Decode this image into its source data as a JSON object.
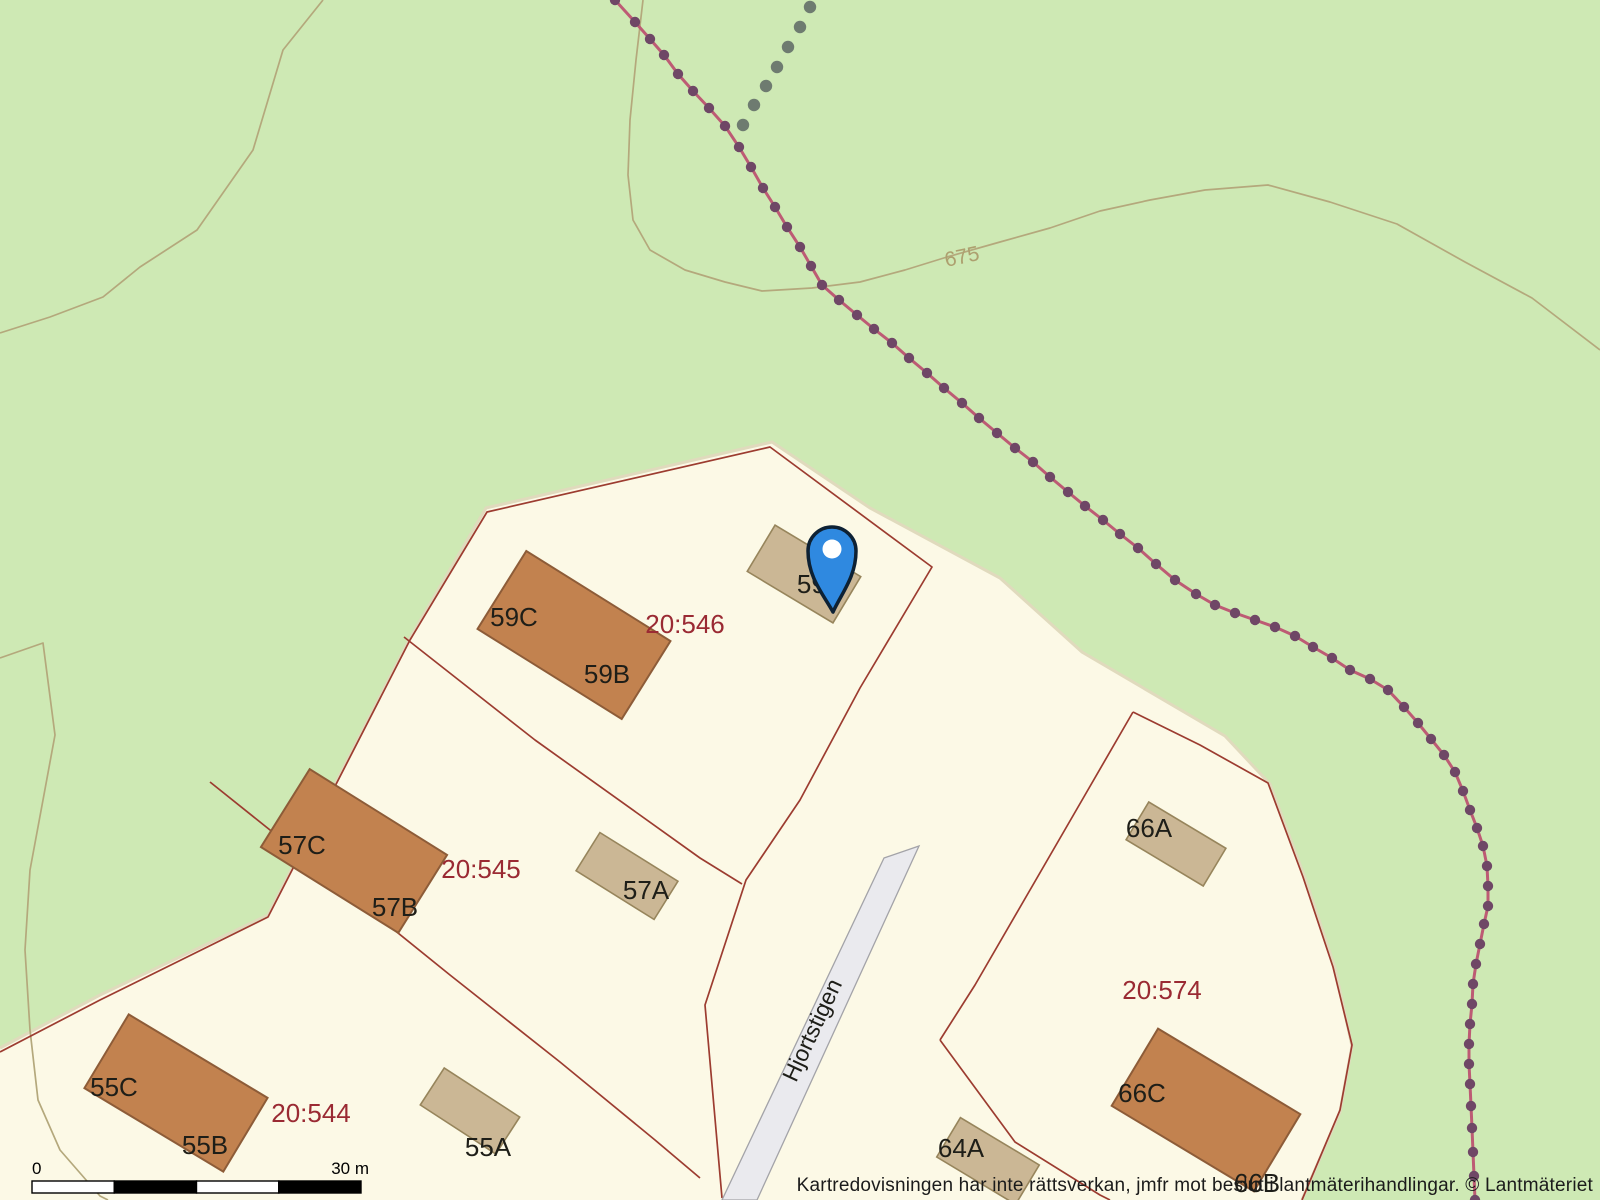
{
  "map": {
    "attribution": "Kartredovisningen har inte rättsverkan, jmfr mot beslut i lantmäterihandlingar. © Lantmäteriet",
    "scale_bar": {
      "start_label": "0",
      "end_label": "30 m",
      "x": 32,
      "y": 1181,
      "segment_width": 82.25,
      "height": 12,
      "segments": 4
    },
    "street": {
      "name": "Hjortstigen",
      "x": 812,
      "y": 1030,
      "rotation": -65
    },
    "contour_label": {
      "text": "675",
      "x": 962,
      "y": 257,
      "rotation": -12
    },
    "colors": {
      "bg_green": "#cee9b4",
      "cream": "#fcf9e6",
      "cream_edge": "#e0dabd",
      "contour": "#b4a87c",
      "contour_label": "#ada06f",
      "boundary": "#9c3c30",
      "parcel_label": "#9a2a33",
      "building_main": "#c2824f",
      "building_main_edge": "#8d5c38",
      "building_acc": "#cbb795",
      "building_acc_edge": "#97855c",
      "road_fill": "#eaeaee",
      "road_edge": "#a3a3a8",
      "trail_line": "#bd5b74",
      "trail_dot": "#6f4766",
      "gray_dot": "#6e7b70",
      "pin_fill": "#2f89e0",
      "pin_stroke": "#0d2134",
      "label_black": "#1e1e18"
    },
    "residential_area": [
      [
        0,
        1048
      ],
      [
        100,
        995
      ],
      [
        268,
        915
      ],
      [
        410,
        638
      ],
      [
        486,
        508
      ],
      [
        772,
        442
      ],
      [
        870,
        508
      ],
      [
        1000,
        578
      ],
      [
        1082,
        652
      ],
      [
        1225,
        736
      ],
      [
        1270,
        784
      ],
      [
        1305,
        878
      ],
      [
        1335,
        968
      ],
      [
        1352,
        1046
      ],
      [
        1340,
        1112
      ],
      [
        1302,
        1200
      ],
      [
        0,
        1200
      ]
    ],
    "residential_rim": [
      [
        0,
        1048
      ],
      [
        100,
        995
      ],
      [
        268,
        915
      ],
      [
        410,
        638
      ],
      [
        486,
        508
      ],
      [
        772,
        442
      ],
      [
        870,
        508
      ],
      [
        1000,
        578
      ],
      [
        1082,
        652
      ],
      [
        1225,
        736
      ],
      [
        1270,
        784
      ],
      [
        1305,
        878
      ],
      [
        1335,
        968
      ],
      [
        1352,
        1046
      ],
      [
        1340,
        1112
      ],
      [
        1302,
        1200
      ]
    ],
    "contours": [
      {
        "name": "contour-topleft",
        "points": [
          [
            323,
            0
          ],
          [
            283,
            50
          ],
          [
            253,
            150
          ],
          [
            197,
            230
          ],
          [
            140,
            267
          ],
          [
            103,
            297
          ],
          [
            50,
            317
          ],
          [
            0,
            333
          ]
        ]
      },
      {
        "name": "contour-675",
        "points": [
          [
            643,
            0
          ],
          [
            636,
            60
          ],
          [
            630,
            120
          ],
          [
            628,
            175
          ],
          [
            633,
            220
          ],
          [
            650,
            250
          ],
          [
            685,
            270
          ],
          [
            725,
            282
          ],
          [
            762,
            291
          ],
          [
            812,
            288
          ],
          [
            860,
            282
          ],
          [
            905,
            270
          ],
          [
            947,
            257
          ],
          [
            1000,
            242
          ],
          [
            1050,
            228
          ],
          [
            1100,
            211
          ],
          [
            1150,
            200
          ],
          [
            1205,
            190
          ],
          [
            1268,
            185
          ],
          [
            1330,
            202
          ],
          [
            1397,
            224
          ],
          [
            1465,
            262
          ],
          [
            1532,
            298
          ],
          [
            1600,
            350
          ]
        ]
      },
      {
        "name": "contour-left-hook",
        "points": [
          [
            0,
            658
          ],
          [
            43,
            643
          ],
          [
            55,
            735
          ],
          [
            43,
            800
          ],
          [
            30,
            870
          ],
          [
            25,
            950
          ],
          [
            30,
            1030
          ],
          [
            38,
            1100
          ],
          [
            60,
            1150
          ],
          [
            100,
            1196
          ],
          [
            108,
            1200
          ]
        ]
      }
    ],
    "boundaries": [
      {
        "name": "boundary-outer",
        "points": [
          [
            0,
            1052
          ],
          [
            100,
            1000
          ],
          [
            268,
            917
          ],
          [
            410,
            640
          ],
          [
            487,
            512
          ],
          [
            770,
            447
          ],
          [
            932,
            567
          ],
          [
            860,
            688
          ],
          [
            800,
            800
          ],
          [
            746,
            880
          ],
          [
            705,
            1005
          ],
          [
            722,
            1198
          ]
        ]
      },
      {
        "name": "boundary-546-545",
        "points": [
          [
            404,
            637
          ],
          [
            535,
            740
          ],
          [
            700,
            858
          ],
          [
            742,
            884
          ]
        ]
      },
      {
        "name": "boundary-545-544",
        "points": [
          [
            210,
            782
          ],
          [
            330,
            878
          ],
          [
            450,
            975
          ],
          [
            560,
            1062
          ],
          [
            655,
            1140
          ],
          [
            700,
            1178
          ]
        ]
      },
      {
        "name": "boundary-574-west",
        "points": [
          [
            1133,
            712
          ],
          [
            1085,
            795
          ],
          [
            1030,
            890
          ],
          [
            975,
            985
          ],
          [
            940,
            1040
          ]
        ]
      },
      {
        "name": "boundary-574-south",
        "points": [
          [
            940,
            1040
          ],
          [
            1015,
            1142
          ],
          [
            1100,
            1195
          ],
          [
            1110,
            1200
          ]
        ]
      },
      {
        "name": "boundary-574-east",
        "points": [
          [
            1133,
            712
          ],
          [
            1200,
            745
          ],
          [
            1268,
            783
          ],
          [
            1303,
            877
          ],
          [
            1333,
            967
          ],
          [
            1352,
            1045
          ],
          [
            1340,
            1110
          ],
          [
            1302,
            1200
          ]
        ]
      }
    ],
    "road": {
      "outline": [
        [
          884,
          858
        ],
        [
          919,
          846
        ],
        [
          757,
          1200
        ],
        [
          722,
          1200
        ]
      ]
    },
    "buildings": [
      {
        "name": "house-59bc",
        "cx": 574,
        "cy": 635,
        "w": 170,
        "h": 92,
        "angle": 32,
        "type": "main"
      },
      {
        "name": "house-57bc",
        "cx": 354,
        "cy": 851,
        "w": 162,
        "h": 92,
        "angle": 32,
        "type": "main"
      },
      {
        "name": "house-55bc",
        "cx": 176,
        "cy": 1093,
        "w": 162,
        "h": 86,
        "angle": 31,
        "type": "main"
      },
      {
        "name": "house-66c",
        "cx": 1206,
        "cy": 1110,
        "w": 166,
        "h": 90,
        "angle": 31,
        "type": "main"
      },
      {
        "name": "house-59a",
        "cx": 804,
        "cy": 574,
        "w": 100,
        "h": 54,
        "angle": 31,
        "type": "accessory"
      },
      {
        "name": "house-57a",
        "cx": 627,
        "cy": 876,
        "w": 92,
        "h": 45,
        "angle": 32,
        "type": "accessory"
      },
      {
        "name": "house-55a",
        "cx": 470,
        "cy": 1111,
        "w": 90,
        "h": 44,
        "angle": 33,
        "type": "accessory"
      },
      {
        "name": "house-66a",
        "cx": 1176,
        "cy": 844,
        "w": 90,
        "h": 44,
        "angle": 31,
        "type": "accessory"
      },
      {
        "name": "house-64a",
        "cx": 988,
        "cy": 1161,
        "w": 92,
        "h": 46,
        "angle": 31,
        "type": "accessory"
      }
    ],
    "building_labels": [
      {
        "text": "59C",
        "x": 514,
        "y": 617
      },
      {
        "text": "59B",
        "x": 607,
        "y": 674
      },
      {
        "text": "59A",
        "x": 820,
        "y": 584
      },
      {
        "text": "57C",
        "x": 302,
        "y": 845
      },
      {
        "text": "57B",
        "x": 395,
        "y": 907
      },
      {
        "text": "57A",
        "x": 646,
        "y": 890
      },
      {
        "text": "55C",
        "x": 114,
        "y": 1087
      },
      {
        "text": "55B",
        "x": 205,
        "y": 1145
      },
      {
        "text": "55A",
        "x": 488,
        "y": 1147
      },
      {
        "text": "66A",
        "x": 1149,
        "y": 828
      },
      {
        "text": "66C",
        "x": 1142,
        "y": 1093
      },
      {
        "text": "66B",
        "x": 1257,
        "y": 1183
      },
      {
        "text": "64A",
        "x": 961,
        "y": 1148
      }
    ],
    "parcel_labels": [
      {
        "text": "20:546",
        "x": 685,
        "y": 624
      },
      {
        "text": "20:545",
        "x": 481,
        "y": 869
      },
      {
        "text": "20:544",
        "x": 311,
        "y": 1113
      },
      {
        "text": "20:574",
        "x": 1162,
        "y": 990
      }
    ],
    "trail": {
      "points": [
        [
          615,
          0
        ],
        [
          635,
          22
        ],
        [
          650,
          39
        ],
        [
          664,
          55
        ],
        [
          678,
          74
        ],
        [
          693,
          91
        ],
        [
          709,
          108
        ],
        [
          725,
          126
        ],
        [
          739,
          147
        ],
        [
          751,
          167
        ],
        [
          763,
          188
        ],
        [
          775,
          207
        ],
        [
          787,
          227
        ],
        [
          800,
          247
        ],
        [
          811,
          266
        ],
        [
          822,
          285
        ],
        [
          839,
          300
        ],
        [
          857,
          315
        ],
        [
          874,
          329
        ],
        [
          892,
          343
        ],
        [
          909,
          358
        ],
        [
          927,
          373
        ],
        [
          944,
          388
        ],
        [
          962,
          403
        ],
        [
          979,
          418
        ],
        [
          997,
          433
        ],
        [
          1015,
          448
        ],
        [
          1033,
          462
        ],
        [
          1050,
          477
        ],
        [
          1068,
          492
        ],
        [
          1085,
          506
        ],
        [
          1103,
          520
        ],
        [
          1120,
          534
        ],
        [
          1138,
          548
        ],
        [
          1156,
          564
        ],
        [
          1175,
          580
        ],
        [
          1196,
          594
        ],
        [
          1215,
          605
        ],
        [
          1235,
          613
        ],
        [
          1255,
          620
        ],
        [
          1275,
          627
        ],
        [
          1295,
          636
        ],
        [
          1313,
          647
        ],
        [
          1332,
          658
        ],
        [
          1350,
          670
        ],
        [
          1370,
          679
        ],
        [
          1388,
          690
        ],
        [
          1404,
          707
        ],
        [
          1418,
          723
        ],
        [
          1431,
          739
        ],
        [
          1444,
          755
        ],
        [
          1455,
          772
        ],
        [
          1463,
          791
        ],
        [
          1470,
          810
        ],
        [
          1477,
          828
        ],
        [
          1483,
          846
        ],
        [
          1487,
          866
        ],
        [
          1488,
          886
        ],
        [
          1488,
          906
        ],
        [
          1484,
          924
        ],
        [
          1480,
          944
        ],
        [
          1476,
          964
        ],
        [
          1473,
          984
        ],
        [
          1472,
          1004
        ],
        [
          1470,
          1024
        ],
        [
          1469,
          1044
        ],
        [
          1469,
          1064
        ],
        [
          1470,
          1084
        ],
        [
          1471,
          1106
        ],
        [
          1472,
          1128
        ],
        [
          1473,
          1152
        ],
        [
          1474,
          1176
        ],
        [
          1475,
          1200
        ]
      ],
      "dot_radius": 5.2,
      "line_width": 3
    },
    "gray_dots": {
      "points": [
        [
          810,
          7
        ],
        [
          800,
          27
        ],
        [
          788,
          47
        ],
        [
          777,
          67
        ],
        [
          766,
          86
        ],
        [
          754,
          105
        ],
        [
          743,
          125
        ]
      ],
      "dot_radius": 6.2
    },
    "pin": {
      "cx": 832,
      "cy": 551,
      "r": 24,
      "tip_x": 833,
      "tip_y": 612,
      "hole_r": 9.5
    }
  }
}
